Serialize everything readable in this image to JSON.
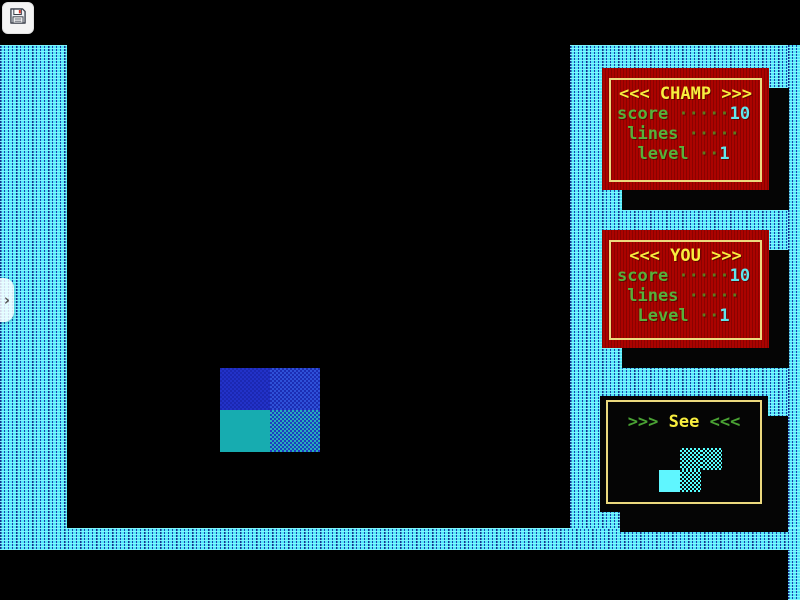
{
  "overlay": {
    "save_button_icon": "floppy-disk-icon",
    "sidebar_toggle_glyph": "›"
  },
  "panels": {
    "champ": {
      "title": "<<< CHAMP >>>",
      "stats": [
        {
          "label": "score ",
          "dots": "·····",
          "value": "10"
        },
        {
          "label": " lines ",
          "dots": "·····",
          "value": ""
        },
        {
          "label": "  level ",
          "dots": "··",
          "value": "1"
        }
      ]
    },
    "you": {
      "title": "<<< YOU >>>",
      "stats": [
        {
          "label": "score ",
          "dots": "·····",
          "value": "10"
        },
        {
          "label": " lines ",
          "dots": "·····",
          "value": ""
        },
        {
          "label": "  Level ",
          "dots": "··",
          "value": "1"
        }
      ]
    },
    "see": {
      "prefix": ">>> ",
      "word": "See",
      "suffix": " <<<",
      "next_piece": "s-piece"
    }
  },
  "game_state": {
    "champ": {
      "score": 10,
      "lines": 0,
      "level": 1
    },
    "you": {
      "score": 10,
      "lines": 0,
      "level": 1
    }
  },
  "colors": {
    "wall_cyan": "#55e8f8",
    "wall_navy": "#1c40ae",
    "panel_red": "#ab0300",
    "panel_border_yellow": "#ecd97e",
    "title_yellow": "#f8ee3e",
    "label_green": "#56b13a",
    "dots_olive": "#5c7a1e",
    "value_cyan": "#5fe6ee",
    "arrow_green": "#4aa234",
    "piece_blue": "#2232c8",
    "piece_blue_light": "#2e51d8",
    "piece_teal": "#17acb0",
    "preview_cyan": "#55ffff",
    "background": "#000000"
  }
}
